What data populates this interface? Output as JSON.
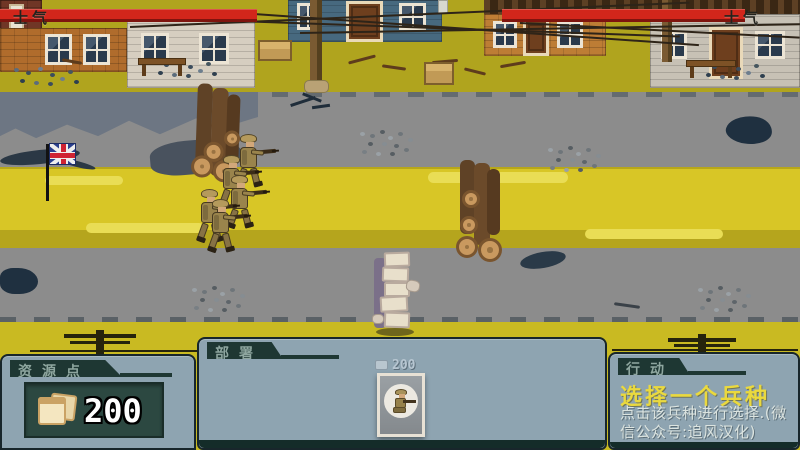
{
  "hud": {
    "player_morale_label": "士气",
    "enemy_morale_label": "士气"
  },
  "panels": {
    "resources": {
      "header": "资源点",
      "amount": "200"
    },
    "deploy": {
      "header": "部署",
      "unit": {
        "cost": "200"
      }
    },
    "action": {
      "header": "行动",
      "title": "选择一个兵种",
      "description": "点击该兵种进行选择.(微信公众号:追风汉化)"
    }
  },
  "scene": {
    "flag_icon": "union-jack-flag",
    "resource_icon": "bread-icon"
  },
  "colors": {
    "morale_red": "#d2261b",
    "panel_frame": "#8ea4b1",
    "panel_dark": "#2c4841",
    "accent_yellow": "#ead93e"
  }
}
